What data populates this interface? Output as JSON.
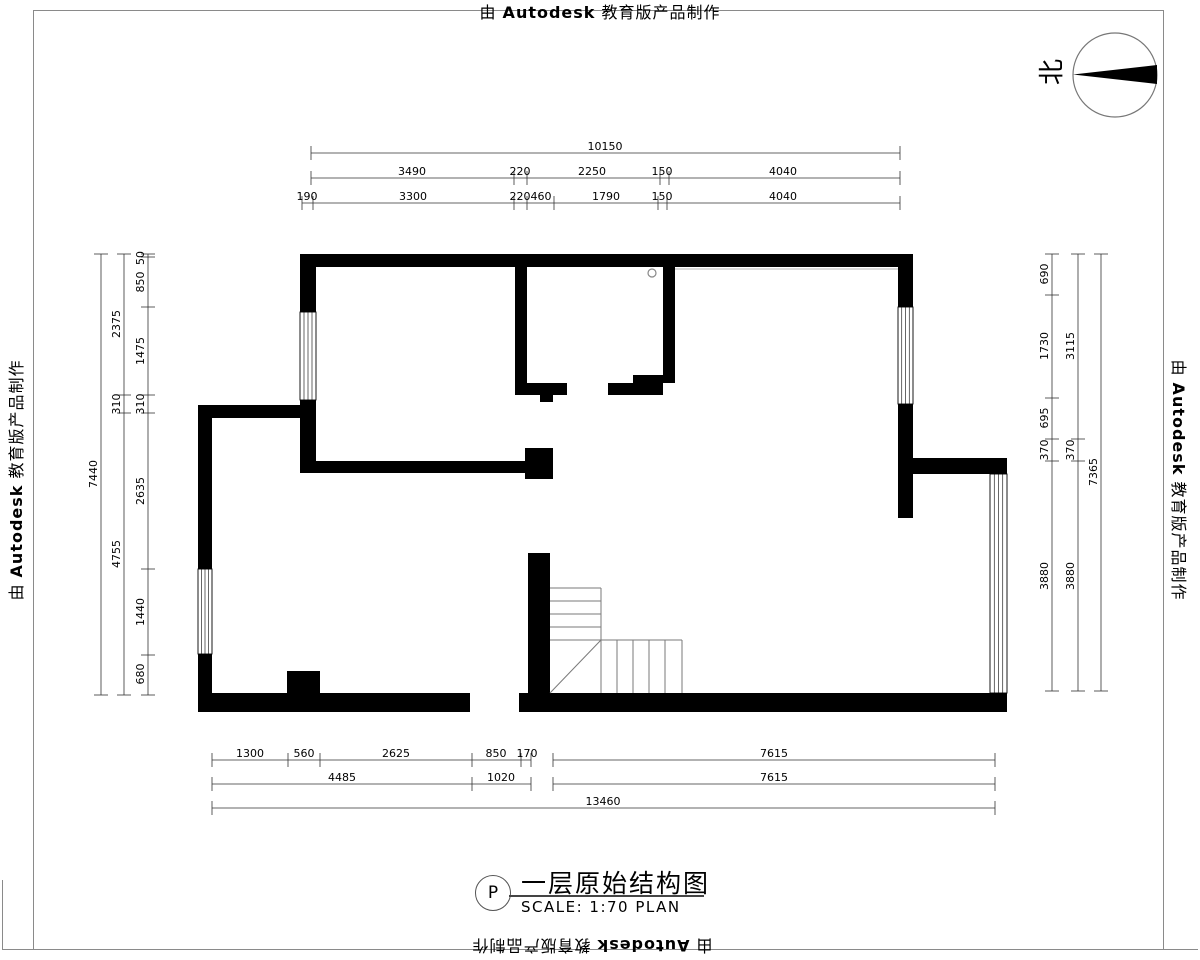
{
  "stamp": {
    "prefix": "由",
    "brand": "Autodesk",
    "suffix": "教育版产品制作"
  },
  "north_label": "北",
  "title_block": {
    "tag": "P",
    "title": "一层原始结构图",
    "scale": "SCALE: 1:70 PLAN"
  },
  "colors": {
    "wall": "#000000",
    "dim": "#333333",
    "stair": "#7a7a7a",
    "frame": "#8a8a8a"
  },
  "plan": {
    "walls": [
      [
        300,
        254,
        613,
        13
      ],
      [
        300,
        254,
        16,
        58
      ],
      [
        300,
        400,
        16,
        73
      ],
      [
        198,
        405,
        118,
        13
      ],
      [
        198,
        418,
        14,
        151
      ],
      [
        198,
        654,
        14,
        58
      ],
      [
        198,
        693,
        272,
        19
      ],
      [
        287,
        671,
        33,
        22
      ],
      [
        519,
        693,
        488,
        19
      ],
      [
        528,
        553,
        22,
        140
      ],
      [
        300,
        461,
        225,
        12
      ],
      [
        525,
        448,
        28,
        31
      ],
      [
        515,
        254,
        12,
        141
      ],
      [
        527,
        383,
        40,
        12
      ],
      [
        540,
        395,
        13,
        7
      ],
      [
        608,
        383,
        55,
        12
      ],
      [
        633,
        375,
        42,
        8
      ],
      [
        663,
        254,
        12,
        129
      ],
      [
        898,
        254,
        15,
        53
      ],
      [
        898,
        404,
        15,
        114
      ],
      [
        898,
        458,
        109,
        16
      ]
    ],
    "windows": [
      {
        "x": 300,
        "y": 312,
        "w": 16,
        "h": 88
      },
      {
        "x": 198,
        "y": 569,
        "w": 14,
        "h": 85
      },
      {
        "x": 898,
        "y": 307,
        "w": 15,
        "h": 97
      },
      {
        "x": 990,
        "y": 474,
        "w": 17,
        "h": 219
      }
    ],
    "stair_lines": [
      [
        550,
        588,
        601,
        588
      ],
      [
        601,
        588,
        601,
        640
      ],
      [
        550,
        601,
        601,
        601
      ],
      [
        550,
        614,
        601,
        614
      ],
      [
        550,
        627,
        601,
        627
      ],
      [
        550,
        640,
        601,
        640
      ],
      [
        550,
        693,
        601,
        640
      ],
      [
        601,
        640,
        601,
        693
      ],
      [
        601,
        640,
        682,
        640
      ],
      [
        682,
        640,
        682,
        693
      ],
      [
        617,
        640,
        617,
        693
      ],
      [
        633,
        640,
        633,
        693
      ],
      [
        649,
        640,
        649,
        693
      ],
      [
        665,
        640,
        665,
        693
      ]
    ],
    "face_lines": [
      [
        675,
        269,
        898,
        269
      ]
    ],
    "fixture_circle": {
      "cx": 652,
      "cy": 273,
      "r": 4
    }
  },
  "dimensions": {
    "h_rows": [
      {
        "y": 153,
        "segments": [
          [
            311,
            900
          ]
        ],
        "ticks": [
          311,
          900
        ],
        "labels": [
          {
            "t": "10150",
            "x": 605
          }
        ]
      },
      {
        "y": 178,
        "segments": [
          [
            311,
            900
          ]
        ],
        "ticks": [
          311,
          514,
          527,
          660,
          669,
          900
        ],
        "labels": [
          {
            "t": "3490",
            "x": 412
          },
          {
            "t": "220",
            "x": 520
          },
          {
            "t": "2250",
            "x": 592
          },
          {
            "t": "150",
            "x": 662
          },
          {
            "t": "4040",
            "x": 783
          }
        ]
      },
      {
        "y": 203,
        "segments": [
          [
            302,
            900
          ]
        ],
        "ticks": [
          302,
          313,
          514,
          527,
          554,
          658,
          667,
          900
        ],
        "labels": [
          {
            "t": "190",
            "x": 307
          },
          {
            "t": "3300",
            "x": 413
          },
          {
            "t": "220",
            "x": 520
          },
          {
            "t": "460",
            "x": 541
          },
          {
            "t": "1790",
            "x": 606
          },
          {
            "t": "150",
            "x": 662
          },
          {
            "t": "4040",
            "x": 783
          }
        ]
      },
      {
        "y": 760,
        "segments": [
          [
            212,
            531
          ],
          [
            553,
            995
          ]
        ],
        "ticks": [
          212,
          288,
          320,
          472,
          521,
          531,
          553,
          995
        ],
        "labels": [
          {
            "t": "1300",
            "x": 250
          },
          {
            "t": "560",
            "x": 304
          },
          {
            "t": "2625",
            "x": 396
          },
          {
            "t": "850",
            "x": 496
          },
          {
            "t": "170",
            "x": 527
          },
          {
            "t": "7615",
            "x": 774
          }
        ]
      },
      {
        "y": 784,
        "segments": [
          [
            212,
            531
          ],
          [
            553,
            995
          ]
        ],
        "ticks": [
          212,
          472,
          531,
          553,
          995
        ],
        "labels": [
          {
            "t": "4485",
            "x": 342
          },
          {
            "t": "1020",
            "x": 501
          },
          {
            "t": "7615",
            "x": 774
          }
        ]
      },
      {
        "y": 808,
        "segments": [
          [
            212,
            995
          ]
        ],
        "ticks": [
          212,
          995
        ],
        "labels": [
          {
            "t": "13460",
            "x": 603
          }
        ]
      }
    ],
    "v_cols": [
      {
        "x": 101,
        "ticks": [
          254,
          695
        ],
        "labels": [
          {
            "t": "7440",
            "y": 474
          }
        ]
      },
      {
        "x": 124,
        "ticks": [
          254,
          395,
          413,
          695
        ],
        "labels": [
          {
            "t": "2375",
            "y": 324
          },
          {
            "t": "310",
            "y": 404
          },
          {
            "t": "4755",
            "y": 554
          }
        ]
      },
      {
        "x": 148,
        "ticks": [
          254,
          257,
          307,
          395,
          413,
          569,
          655,
          695
        ],
        "labels": [
          {
            "t": "50",
            "y": 258
          },
          {
            "t": "850",
            "y": 282
          },
          {
            "t": "1475",
            "y": 351
          },
          {
            "t": "310",
            "y": 404
          },
          {
            "t": "2635",
            "y": 491
          },
          {
            "t": "1440",
            "y": 612
          },
          {
            "t": "680",
            "y": 674
          }
        ]
      },
      {
        "x": 1052,
        "ticks": [
          254,
          295,
          398,
          439,
          461,
          691
        ],
        "labels": [
          {
            "t": "690",
            "y": 274
          },
          {
            "t": "1730",
            "y": 346
          },
          {
            "t": "695",
            "y": 418
          },
          {
            "t": "370",
            "y": 450
          },
          {
            "t": "3880",
            "y": 576
          }
        ]
      },
      {
        "x": 1078,
        "ticks": [
          254,
          439,
          461,
          691
        ],
        "labels": [
          {
            "t": "3115",
            "y": 346
          },
          {
            "t": "370",
            "y": 450
          },
          {
            "t": "3880",
            "y": 576
          }
        ]
      },
      {
        "x": 1101,
        "ticks": [
          254,
          691
        ],
        "labels": [
          {
            "t": "7365",
            "y": 472
          }
        ]
      }
    ]
  }
}
